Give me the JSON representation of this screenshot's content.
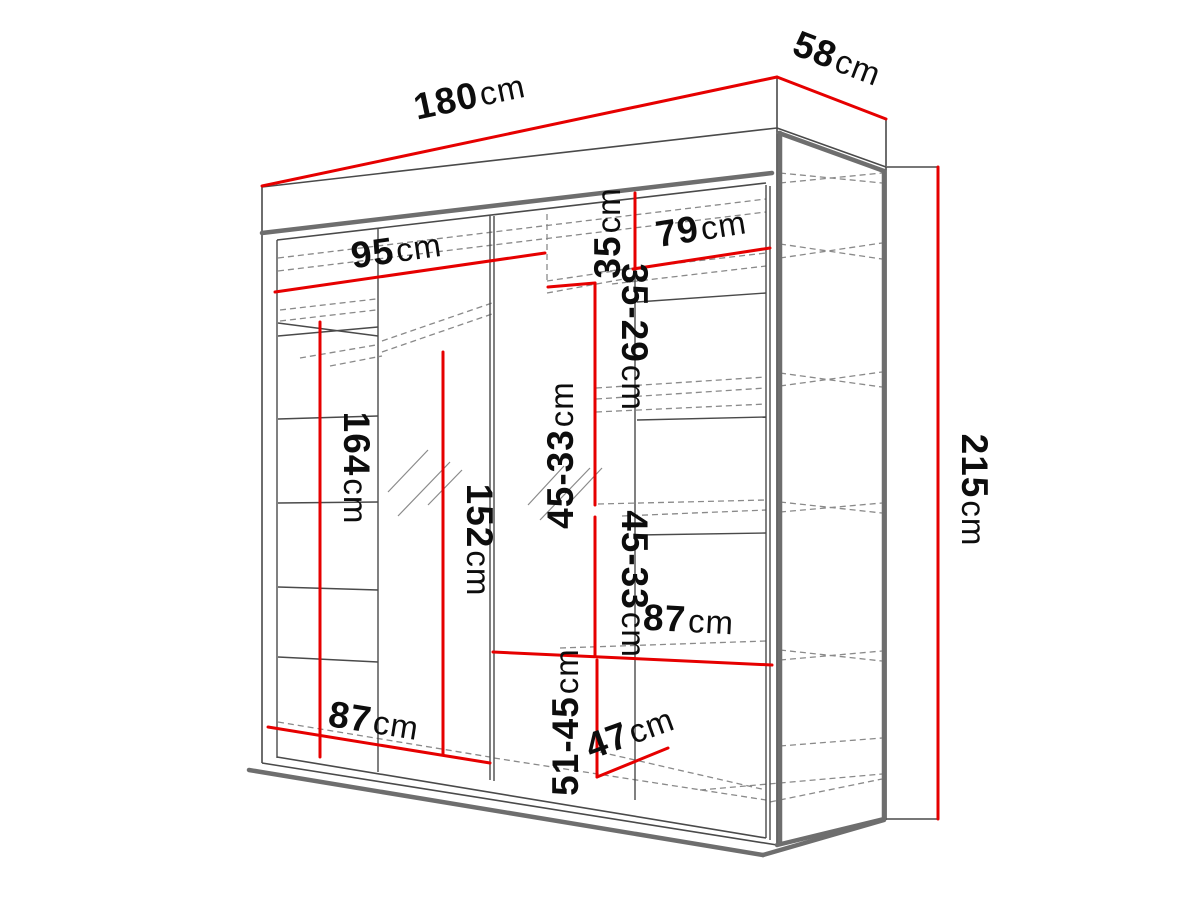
{
  "diagram": {
    "title": "wardrobe-dimension-drawing",
    "unit": "cm",
    "colors": {
      "dimension_line": "#e60000",
      "outline": "#4a4a4a",
      "outline_thick": "#6e6e6e",
      "hidden_line": "#8a8a8a",
      "background": "#ffffff",
      "label_text": "#0d0d0d"
    },
    "dims": {
      "total_width": {
        "value": "180",
        "unit": "cm"
      },
      "depth": {
        "value": "58",
        "unit": "cm"
      },
      "total_height": {
        "value": "215",
        "unit": "cm"
      },
      "top_left_width": {
        "value": "95",
        "unit": "cm"
      },
      "top_right_width": {
        "value": "79",
        "unit": "cm"
      },
      "top_section_height": {
        "value": "35",
        "unit": "cm"
      },
      "upper_shelf_range": {
        "value": "35-29",
        "unit": "cm"
      },
      "middle_shelf_range_1": {
        "value": "45-33",
        "unit": "cm"
      },
      "middle_shelf_range_2": {
        "value": "45-33",
        "unit": "cm"
      },
      "right_shelf_width": {
        "value": "87",
        "unit": "cm"
      },
      "left_bottom_width": {
        "value": "87",
        "unit": "cm"
      },
      "bottom_shelf_range": {
        "value": "51-45",
        "unit": "cm"
      },
      "bottom_depth": {
        "value": "47",
        "unit": "cm"
      },
      "left_section_height": {
        "value": "164",
        "unit": "cm"
      },
      "middle_section_height": {
        "value": "152",
        "unit": "cm"
      }
    }
  }
}
